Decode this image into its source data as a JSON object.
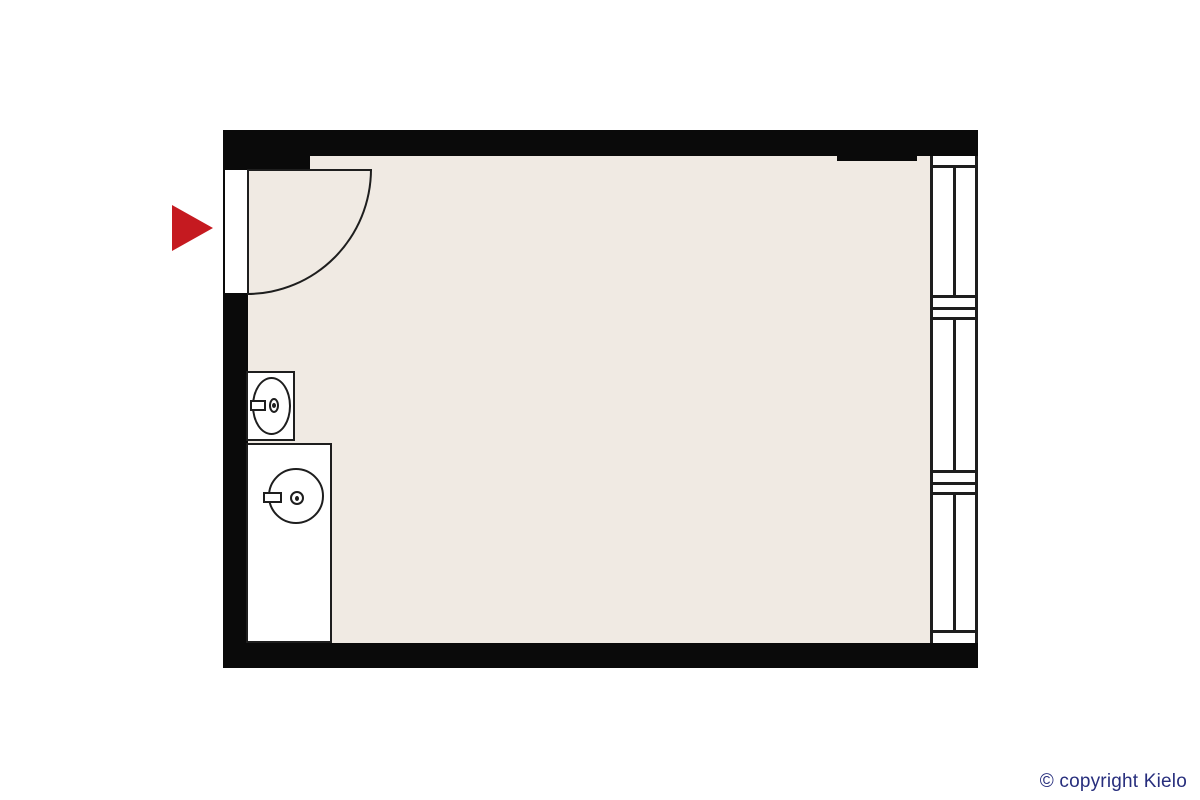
{
  "footer": {
    "copyright": "© copyright Kielo"
  },
  "colors": {
    "background": "#ffffff",
    "wall": "#0a0a0a",
    "line": "#1e1e1e",
    "floor": "#f0eae3",
    "fixture": "#ffffff",
    "arrow": "#c51a20",
    "copyright": "#272e7d"
  },
  "plan": {
    "entrance": {
      "icon": "entrance-arrow",
      "direction": "right"
    },
    "door": {
      "type": "single-leaf-swing",
      "wall": "left"
    },
    "windows": {
      "wall": "right",
      "pane_count": 3
    },
    "fixtures": [
      {
        "name": "washbasin"
      },
      {
        "name": "sink-unit"
      }
    ]
  }
}
